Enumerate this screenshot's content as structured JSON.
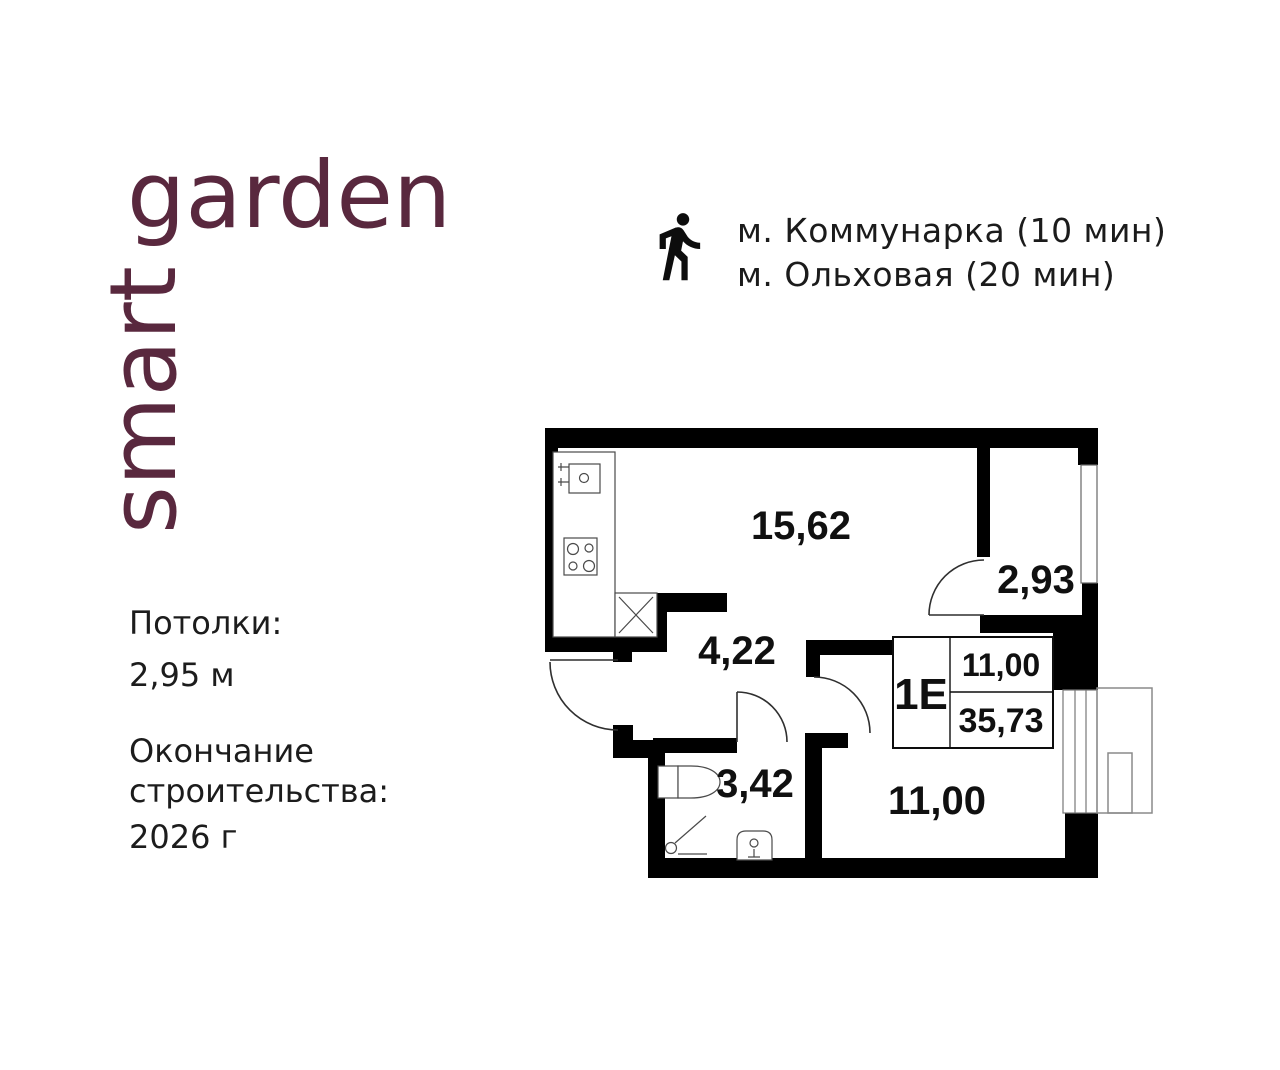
{
  "brand": {
    "vertical_word": "smart",
    "horizontal_word": "garden",
    "color": "#59283e"
  },
  "transit": {
    "icon": "walking-person-icon",
    "lines": [
      "м. Коммунарка (10 мин)",
      "м. Ольховая (20 мин)"
    ]
  },
  "details": {
    "ceiling_label": "Потолки:",
    "ceiling_value": "2,95 м",
    "completion_line1": "Окончание",
    "completion_line2": "строительства:",
    "completion_value": "2026 г"
  },
  "floor_plan": {
    "areas": {
      "living_room": "15,62",
      "wardrobe": "2,93",
      "hallway": "4,22",
      "bathroom": "3,42",
      "bedroom": "11,00"
    },
    "badge": {
      "label": "1Е",
      "room_area": "11,00",
      "total_area": "35,73"
    },
    "wall_color": "#000000"
  },
  "colors": {
    "background": "#ffffff",
    "text": "#1b1b1b",
    "brand": "#59283e"
  }
}
